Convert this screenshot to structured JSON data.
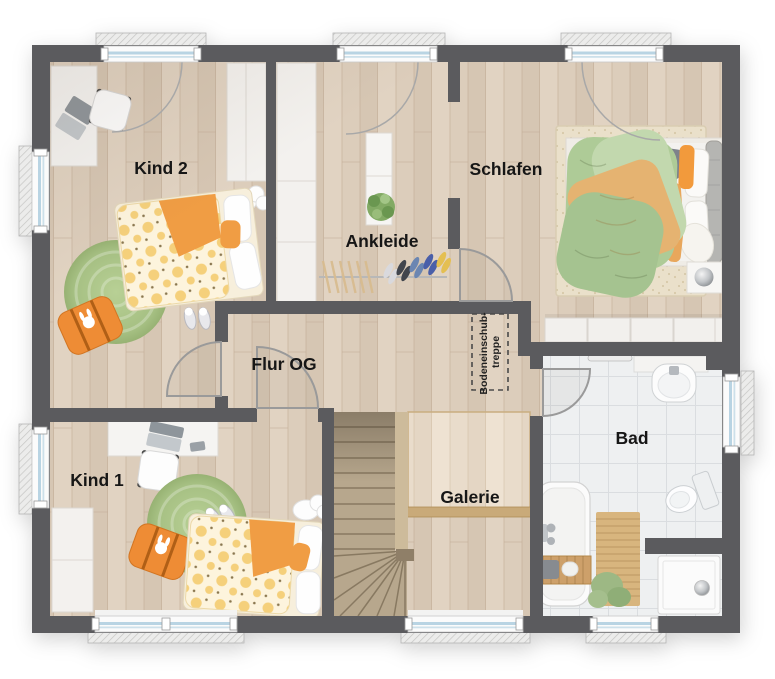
{
  "plan": {
    "type": "floor-plan-top-view",
    "rooms": [
      {
        "id": "kind2",
        "label": "Kind 2"
      },
      {
        "id": "ankleide",
        "label": "Ankleide"
      },
      {
        "id": "schlafen",
        "label": "Schlafen"
      },
      {
        "id": "flur",
        "label": "Flur OG"
      },
      {
        "id": "kind1",
        "label": "Kind 1"
      },
      {
        "id": "galerie",
        "label": "Galerie"
      },
      {
        "id": "bad",
        "label": "Bad"
      }
    ],
    "attic_hatch": {
      "line1": "Bodeneinschub-",
      "line2": "treppe"
    },
    "colors": {
      "wall": "#5b5b5e",
      "floor_wood": "#dccdbb",
      "floor_tile": "#eef0f1",
      "gallery_wood": "#e9dccb",
      "stair_wood": "#b7a78d",
      "accent_orange": "#ee8c35",
      "rug_green": "#a9c287",
      "bedding_green": "#aecb97",
      "bedding_tan": "#e5b371",
      "window_glass": "#b9d4e3"
    }
  }
}
